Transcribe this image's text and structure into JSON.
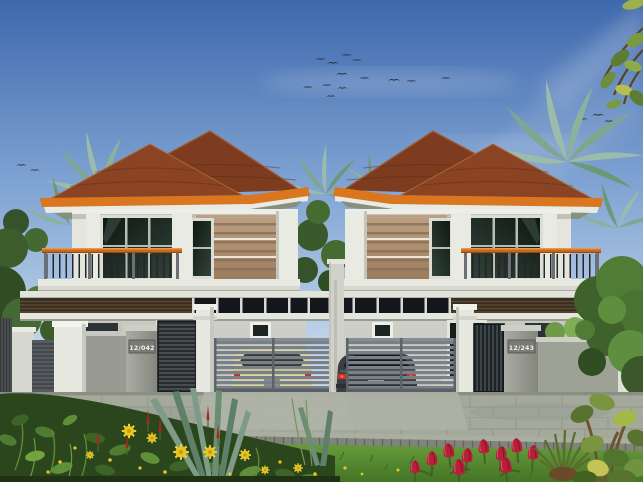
{
  "scene": {
    "type": "architectural-rendering",
    "subject": "twin two-storey houses"
  },
  "houses": {
    "left": {
      "number": "12/042"
    },
    "right": {
      "number": "12/243"
    }
  },
  "colors": {
    "sky_top": "#3e68ac",
    "sky_horizon": "#e7eef5",
    "roof_shingle": "#7d3b1f",
    "roof_fascia_orange": "#d9761f",
    "wall_white": "#eceee6",
    "wall_tan": "#b2967a",
    "window_glass": "#18211c",
    "balcony_rail_orange": "#c8681a",
    "louver_brown": "#3a2e21",
    "gate_gray": "#7a8087",
    "fence_wall_gray": "#999b93",
    "pavement_gray": "#a4a99c",
    "grass_green": "#5e9238",
    "foliage_dark": "#3c5c2b",
    "palm_green": "#9cbcab",
    "flower_yellow": "#e9c51f",
    "flower_red": "#b5203a",
    "car_left_cream": "#dcd7a4",
    "car_right_dark": "#3a3e43",
    "bird": "#2f2f2d"
  }
}
